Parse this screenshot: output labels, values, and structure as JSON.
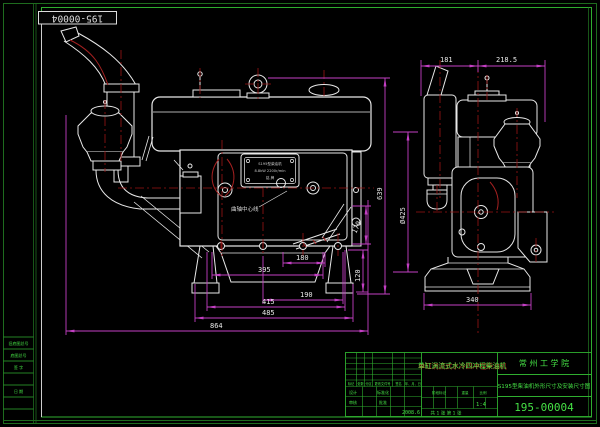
{
  "stamp": {
    "corner_no": "195-00004"
  },
  "views": {
    "front": {
      "dims": {
        "d180": "180",
        "d395": "395",
        "d190": "190",
        "d415": "415",
        "d485": "485",
        "d864": "864",
        "d120": "120",
        "d170": "170",
        "d639": "639",
        "d425": "Ø425"
      },
      "labels": {
        "crank_centerline": "曲轴中心线"
      },
      "nameplate": {
        "line1": "S195型柴油机",
        "line2": "8.8kW 2200r/min",
        "line3": "铭 牌"
      }
    },
    "side": {
      "dims": {
        "d181": "181",
        "d218": "218.5",
        "d340": "340"
      }
    }
  },
  "title_block": {
    "product_title": "单缸涡流式水冷四冲程柴油机",
    "company": "常 州 工 学 院",
    "drawing_title": "S195型柴油机外形尺寸及安装尺寸图",
    "drawing_no": "195-00004",
    "date": "2008.6",
    "scale": "1:4",
    "sheet": "共 1 张  第 1 张",
    "labels": {
      "mark": "标记",
      "count": "处数",
      "zone": "分区",
      "change_doc": "更改文件号",
      "sign": "签名",
      "date_col": "年、月、日",
      "design": "设计",
      "check": "审核",
      "standard": "标准化",
      "approve": "批准",
      "stage": "阶段标记",
      "weight": "重量",
      "scale_label": "比例"
    }
  },
  "margin": {
    "rows": [
      "旧底图总号",
      "底图总号",
      "签 字",
      "日 期"
    ]
  },
  "colors": {
    "border_green": "#1e6b1e",
    "grid_green": "#2fae2f",
    "text_green": "#45e045",
    "line_white": "#e8e8e8",
    "dim_magenta": "#c33fc3",
    "center_red": "#9b1313"
  }
}
